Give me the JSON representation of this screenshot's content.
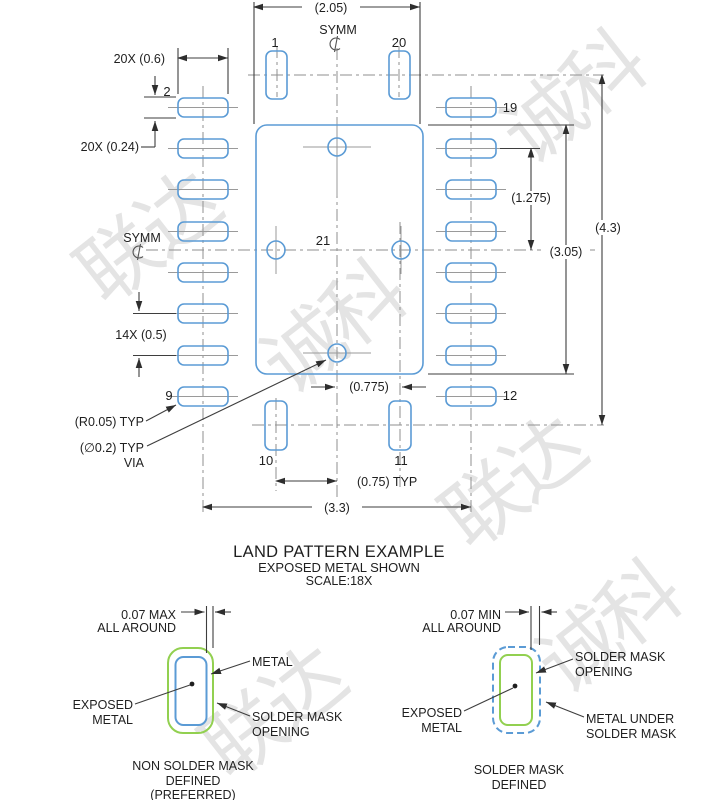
{
  "watermark": {
    "t1": "联达",
    "t2": "诚科"
  },
  "title_block": {
    "title": "LAND PATTERN EXAMPLE",
    "subtitle": "EXPOSED METAL SHOWN",
    "scale": "SCALE:18X"
  },
  "symm": {
    "label": "SYMM"
  },
  "pins": {
    "p1": "1",
    "p2": "2",
    "p9": "9",
    "p10": "10",
    "p11": "11",
    "p12": "12",
    "p19": "19",
    "p20": "20",
    "p21": "21"
  },
  "dims": {
    "overall_w": "(2.05)",
    "pad_w": "20X (0.6)",
    "pad_h": "20X (0.24)",
    "pitch": "14X (0.5)",
    "half_h": "(1.275)",
    "thermal_h": "(3.05)",
    "overall_h": "(4.3)",
    "via_off": "(0.775)",
    "pad_off": "(0.75) TYP",
    "overall_span": "(3.3)",
    "corner_r": "(R0.05) TYP",
    "via_d": "(∅0.2) TYP",
    "via": "VIA"
  },
  "nsmd": {
    "dim_l1": "0.07 MAX",
    "dim_l2": "ALL AROUND",
    "metal": "METAL",
    "exposed_l1": "EXPOSED",
    "exposed_l2": "METAL",
    "opening_l1": "SOLDER MASK",
    "opening_l2": "OPENING",
    "caption_l1": "NON SOLDER MASK",
    "caption_l2": "DEFINED",
    "caption_l3": "(PREFERRED)"
  },
  "smd": {
    "dim_l1": "0.07 MIN",
    "dim_l2": "ALL AROUND",
    "opening_l1": "SOLDER MASK",
    "opening_l2": "OPENING",
    "exposed_l1": "EXPOSED",
    "exposed_l2": "METAL",
    "under_l1": "METAL UNDER",
    "under_l2": "SOLDER MASK",
    "caption_l1": "SOLDER MASK",
    "caption_l2": "DEFINED"
  },
  "colors": {
    "pad_blue": "#5b9bd5",
    "mask_green": "#92d050"
  }
}
